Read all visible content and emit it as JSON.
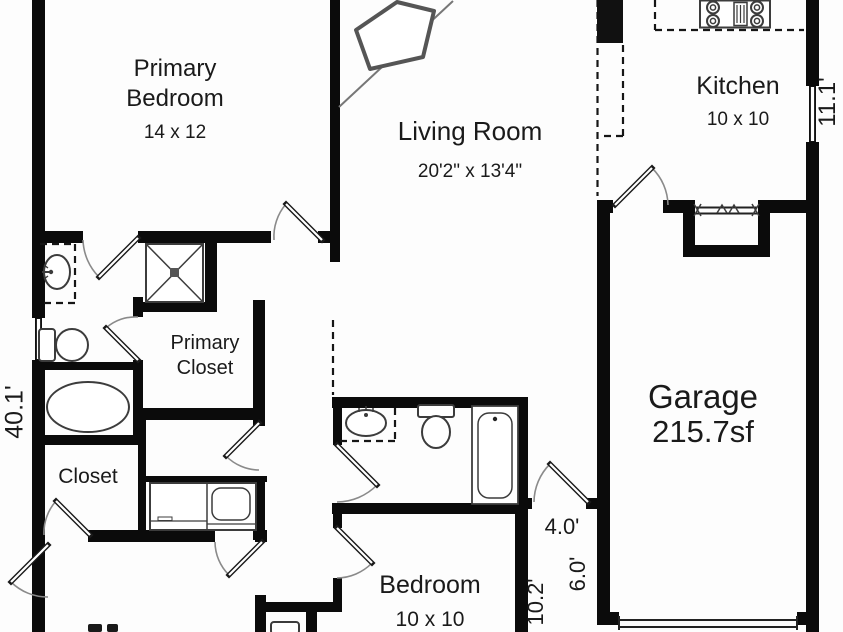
{
  "plan": {
    "title": "Floor plan",
    "rooms": {
      "primary_bedroom": {
        "label": "Primary Bedroom",
        "dims": "14 x 12"
      },
      "living_room": {
        "label": "Living Room",
        "dims": "20'2\" x 13'4\""
      },
      "kitchen": {
        "label": "Kitchen",
        "dims": "10 x 10"
      },
      "garage": {
        "label": "Garage",
        "area": "215.7sf"
      },
      "primary_closet": {
        "label": "Primary Closet"
      },
      "closet": {
        "label": "Closet"
      },
      "bedroom": {
        "label": "Bedroom",
        "dims": "10 x 10"
      }
    },
    "dimensions": {
      "left_height": "40.1'",
      "kitchen_right": "11.1'",
      "nook_width": "4.0'",
      "nook_depth": "6.0'",
      "side_depth": "10.2'"
    },
    "colors": {
      "wall": "#0b0b0b",
      "fixture": "#3c3c3c",
      "text": "#1a1a1a",
      "background": "#fdfdfd"
    }
  }
}
